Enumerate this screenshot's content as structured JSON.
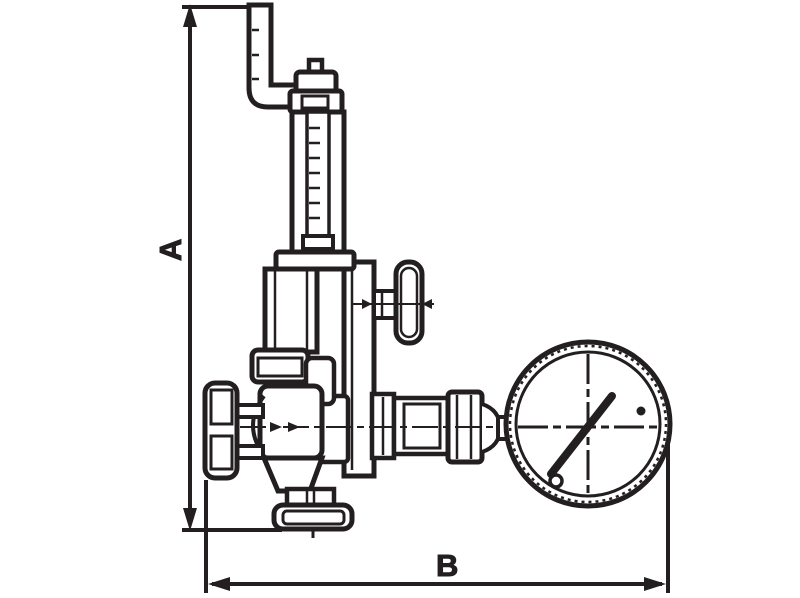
{
  "drawing": {
    "type": "technical-line-drawing",
    "subject": "pressure-reducing-valve-with-gauge",
    "ink_color": "#231f20",
    "background_color": "#ffffff",
    "dimensions": {
      "vertical_label": "A",
      "horizontal_label": "B"
    },
    "components": [
      "inlet-pipe-elbow",
      "adjusting-screw-cap",
      "threaded-adjusting-rod",
      "spring-housing-tube",
      "bonnet",
      "gauge-cock-riser",
      "gauge-cock-handle",
      "inlet-knob",
      "valve-body",
      "bottom-drain-connection",
      "outlet-union-nut",
      "pressure-gauge",
      "gauge-needle",
      "dimension-line-A",
      "dimension-line-B"
    ]
  }
}
